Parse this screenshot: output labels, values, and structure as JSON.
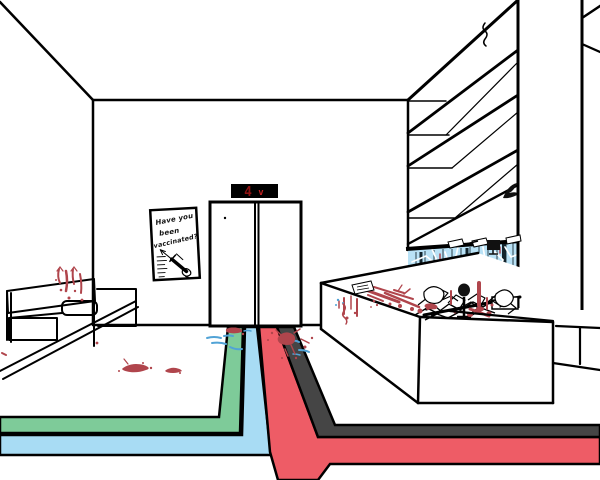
{
  "scene": {
    "description": "Hand-drawn clinic lobby with elevator, bloodied floor and reception",
    "elevator": {
      "floor_display": "4",
      "direction_symbol": "v"
    },
    "poster": {
      "line1": "Have you",
      "line2": "been",
      "line3": "vaccinated?"
    },
    "colors": {
      "line": "#000000",
      "stripe_green": "#7ecb99",
      "stripe_blue": "#a8dcf4",
      "stripe_red": "#ee5c66",
      "stripe_dark": "#454545",
      "blood": "#b0454c",
      "glass": "#b9e2f6",
      "glass_frame": "#13242c",
      "mark_blue": "#51a3d6",
      "display_bg": "#000000",
      "display_digit": "#8e1212",
      "display_arrow": "#c42222"
    }
  }
}
